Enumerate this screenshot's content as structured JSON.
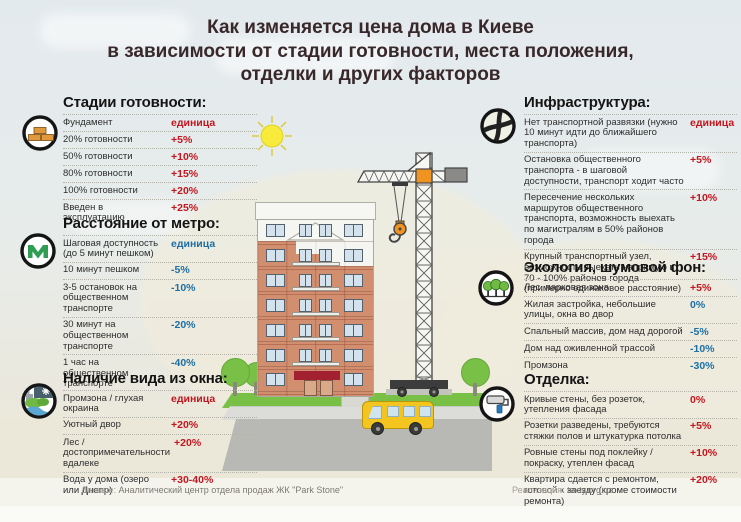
{
  "title": {
    "line1": "Как изменяется цена дома в Киеве",
    "line2": "в зависимости от стадии готовности, места положения,",
    "line3": "отделки и других факторов"
  },
  "sections": [
    {
      "key": "stages",
      "title": "Стадии готовности:",
      "icon": "bricks-icon",
      "rows": [
        {
          "label": "Фундамент",
          "value": "единица",
          "color": "red"
        },
        {
          "label": "20% готовности",
          "value": "+5%",
          "color": "red"
        },
        {
          "label": "50% готовности",
          "value": "+10%",
          "color": "red"
        },
        {
          "label": "80% готовности",
          "value": "+15%",
          "color": "red"
        },
        {
          "label": "100% готовности",
          "value": "+20%",
          "color": "red"
        },
        {
          "label": "Введен в эксплуатацию",
          "value": "+25%",
          "color": "red"
        }
      ]
    },
    {
      "key": "metro",
      "title": "Расстояние от метро:",
      "icon": "metro-icon",
      "rows": [
        {
          "label": "Шаговая доступность (до 5 минут пешком)",
          "value": "единица",
          "color": "blue"
        },
        {
          "label": "10 минут пешком",
          "value": "-5%",
          "color": "blue"
        },
        {
          "label": "3-5 остановок на общественном транспорте",
          "value": "-10%",
          "color": "blue"
        },
        {
          "label": "30 минут на общественном транспорте",
          "value": "-20%",
          "color": "blue"
        },
        {
          "label": "1 час на общественном транспорте",
          "value": "-40%",
          "color": "blue"
        }
      ]
    },
    {
      "key": "window-view",
      "title": "Наличие вида из окна:",
      "icon": "window-view-icon",
      "rows": [
        {
          "label": "Промзона / глухая окраина",
          "value": "единица",
          "color": "red"
        },
        {
          "label": "Уютный двор",
          "value": "+20%",
          "color": "red"
        },
        {
          "label": "Лес / достопримечательности вдалеке",
          "value": "+20%",
          "color": "red"
        },
        {
          "label": "Вода у дома (озеро или Днепр)",
          "value": "+30-40%",
          "color": "red"
        }
      ]
    },
    {
      "key": "infrastructure",
      "title": "Инфраструктура:",
      "icon": "road-junction-icon",
      "rows": [
        {
          "label": "Нет транспортной развязки (нужно 10 минут идти до ближайшего транспорта)",
          "value": "единица",
          "color": "red"
        },
        {
          "label": "Остановка общественного транспорта - в шаговой доступности, транспорт ходит часто",
          "value": "+5%",
          "color": "red"
        },
        {
          "label": "Пересечение нескольких маршрутов общественного транспорта, возможность выехать по магистралям в 50% районов города",
          "value": "+10%",
          "color": "red"
        },
        {
          "label": "Крупный транспортный узел, возможность выехать напрямую в 70 - 100% районов города (примерно одинаковое расстояние)",
          "value": "+15%",
          "color": "red"
        }
      ]
    },
    {
      "key": "ecology",
      "title": "Экология, шумовой фон:",
      "icon": "trees-icon",
      "rows": [
        {
          "label": "Лес, парковая зона",
          "value": "+5%",
          "color": "red"
        },
        {
          "label": "Жилая застройка, небольшие улицы, окна во двор",
          "value": "0%",
          "color": "blue"
        },
        {
          "label": "Спальный массив, дом над дорогой",
          "value": "-5%",
          "color": "blue"
        },
        {
          "label": "Дом над оживленной трассой",
          "value": "-10%",
          "color": "blue"
        },
        {
          "label": "Промзона",
          "value": "-30%",
          "color": "blue"
        }
      ]
    },
    {
      "key": "finishing",
      "title": "Отделка:",
      "icon": "paint-roller-icon",
      "rows": [
        {
          "label": "Кривые стены, без розеток, утепления фасада",
          "value": "0%",
          "color": "red"
        },
        {
          "label": "Розетки разведены, требуются стяжки полов и штукатурка потолка",
          "value": "+5%",
          "color": "red"
        },
        {
          "label": "Ровные стены под поклейку / покраску, утеплен фасад",
          "value": "+10%",
          "color": "red"
        },
        {
          "label": "Квартира сдается с ремонтом, готовой к заезду (кроме стоимости ремонта)",
          "value": "+20%",
          "color": "red"
        }
      ]
    }
  ],
  "footer": {
    "data_label": "Данные:",
    "data_value": "Аналитический центр отдела продаж ЖК \"Park Stone\"",
    "credit_label": "Реализация:",
    "credit_value": "texty.org.ua"
  },
  "colors": {
    "accent_red": "#c3161f",
    "accent_blue": "#1d6fa5",
    "brick": "#d28f6f",
    "lawn_green": "#79c046",
    "bus_yellow": "#f3c51e"
  }
}
